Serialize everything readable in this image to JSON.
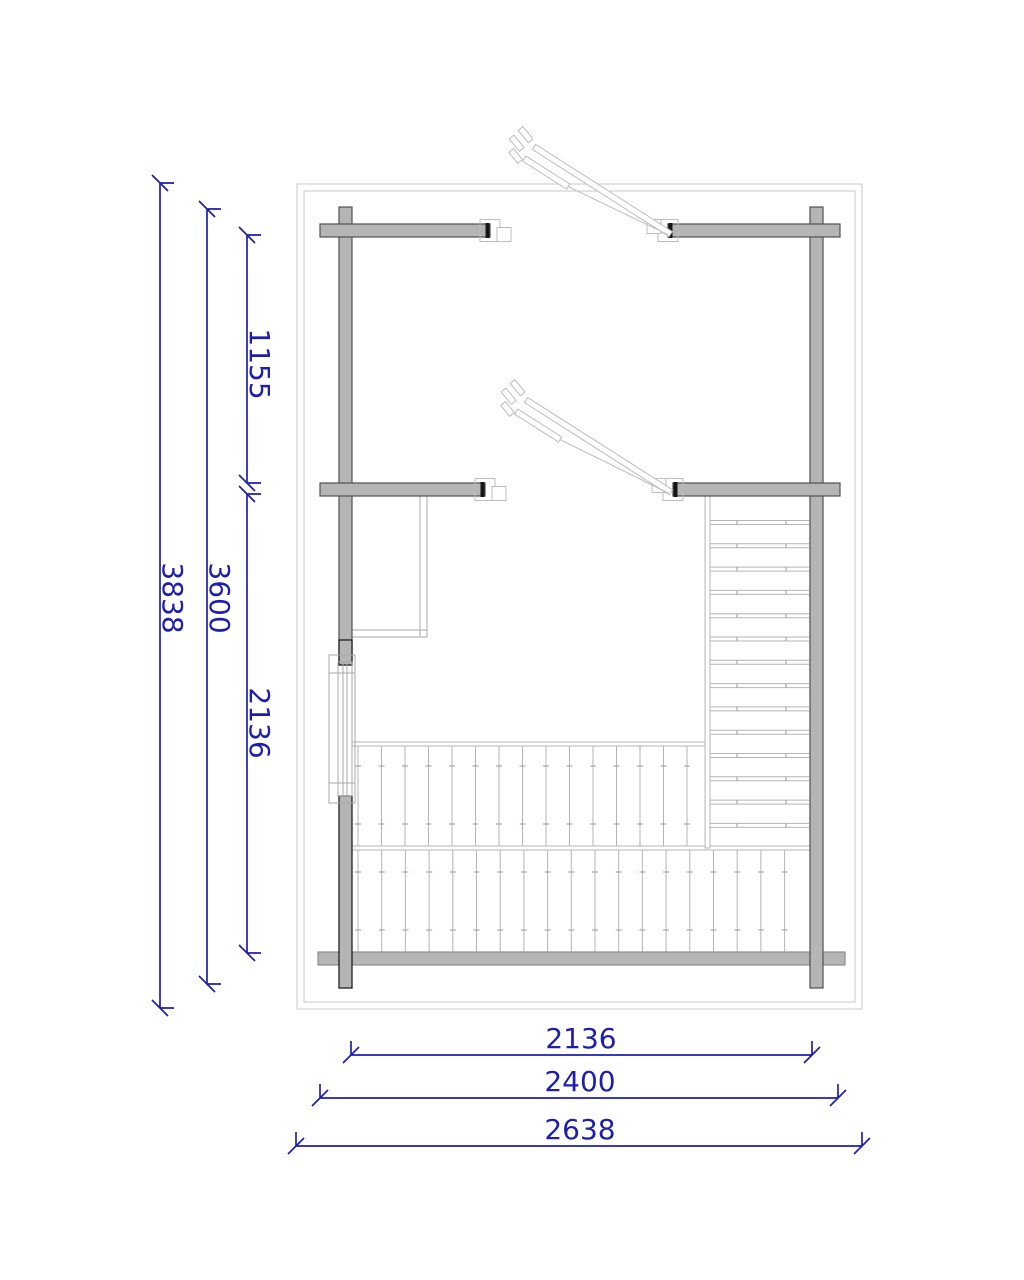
{
  "drawing": {
    "kind": "log-cabin-loft-floor-plan"
  },
  "colors": {
    "dimension": "#1e1eae",
    "wall_fill": "#b5b5b5",
    "wall_outline": "#4f4f4f",
    "light_line": "#b4b4b4",
    "boundary": "#c8c8c8"
  },
  "dimensions": {
    "left": [
      {
        "name": "overall-depth",
        "value": "3838"
      },
      {
        "name": "outer-wall-depth",
        "value": "3600"
      },
      {
        "name": "upper-bay-depth",
        "value": "1155"
      },
      {
        "name": "lower-bay-depth",
        "value": "2136"
      }
    ],
    "bottom": [
      {
        "name": "inner-width",
        "value": "2136"
      },
      {
        "name": "outer-wall-width",
        "value": "2400"
      },
      {
        "name": "overall-width",
        "value": "2638"
      }
    ]
  }
}
